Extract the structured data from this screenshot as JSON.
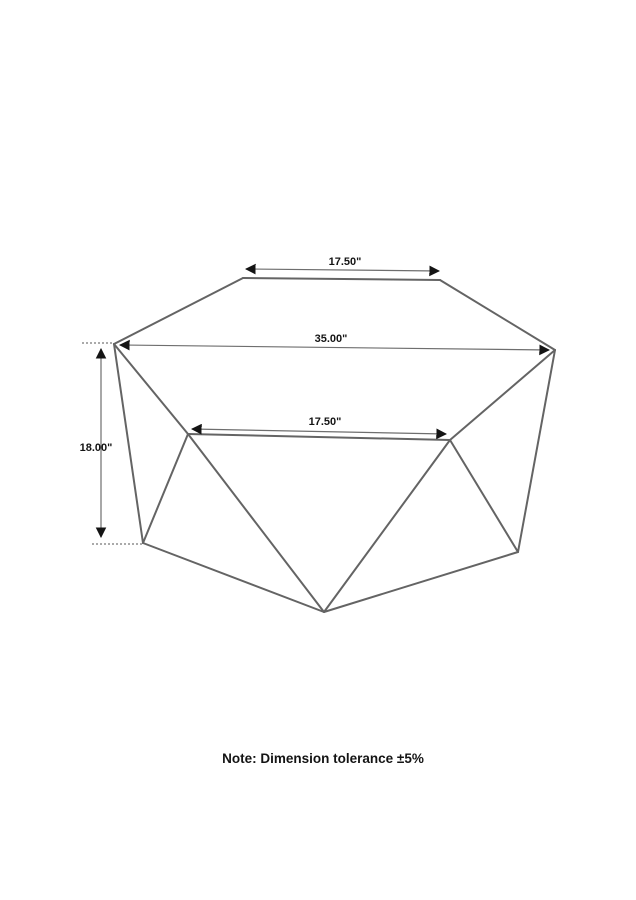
{
  "note": {
    "text": "Note: Dimension tolerance ±5%",
    "x": 323,
    "y": 763
  },
  "colors": {
    "background": "#ffffff",
    "edge": "#646464",
    "dimension_line": "#6e6e6e",
    "arrow": "#141414",
    "text": "#141414"
  },
  "diagram": {
    "description": "geometric-hexagonal-coffee-table-line-drawing",
    "vertices": {
      "L": [
        114,
        344
      ],
      "TL": [
        243,
        278
      ],
      "TR": [
        440,
        280
      ],
      "R": [
        555,
        350
      ],
      "ML": [
        188,
        434
      ],
      "MR": [
        450,
        440
      ],
      "BL": [
        143,
        543
      ],
      "BC": [
        324,
        612
      ],
      "BR": [
        518,
        552
      ]
    },
    "edges": [
      [
        "L",
        "TL"
      ],
      [
        "TL",
        "TR"
      ],
      [
        "TR",
        "R"
      ],
      [
        "L",
        "ML"
      ],
      [
        "L",
        "BL"
      ],
      [
        "R",
        "MR"
      ],
      [
        "R",
        "BR"
      ],
      [
        "ML",
        "MR"
      ],
      [
        "ML",
        "BL"
      ],
      [
        "ML",
        "BC"
      ],
      [
        "MR",
        "BR"
      ],
      [
        "MR",
        "BC"
      ],
      [
        "BL",
        "BC"
      ],
      [
        "BC",
        "BR"
      ]
    ],
    "extension_lines": [
      {
        "x1": 82,
        "y1": 343,
        "x2": 114,
        "y2": 343
      },
      {
        "x1": 92,
        "y1": 544,
        "x2": 143,
        "y2": 544
      }
    ],
    "dimensions": [
      {
        "id": "top-width",
        "label": "17.50\"",
        "x1": 246,
        "y1": 269,
        "x2": 439,
        "y2": 271,
        "label_x": 345,
        "label_y": 265
      },
      {
        "id": "overall-width",
        "label": "35.00\"",
        "x1": 120,
        "y1": 345,
        "x2": 549,
        "y2": 350,
        "label_x": 331,
        "label_y": 342
      },
      {
        "id": "mid-width",
        "label": "17.50\"",
        "x1": 192,
        "y1": 429,
        "x2": 446,
        "y2": 434,
        "label_x": 325,
        "label_y": 425
      },
      {
        "id": "height",
        "label": "18.00\"",
        "x1": 101,
        "y1": 349,
        "x2": 101,
        "y2": 537,
        "label_x": 96,
        "label_y": 451
      }
    ]
  }
}
